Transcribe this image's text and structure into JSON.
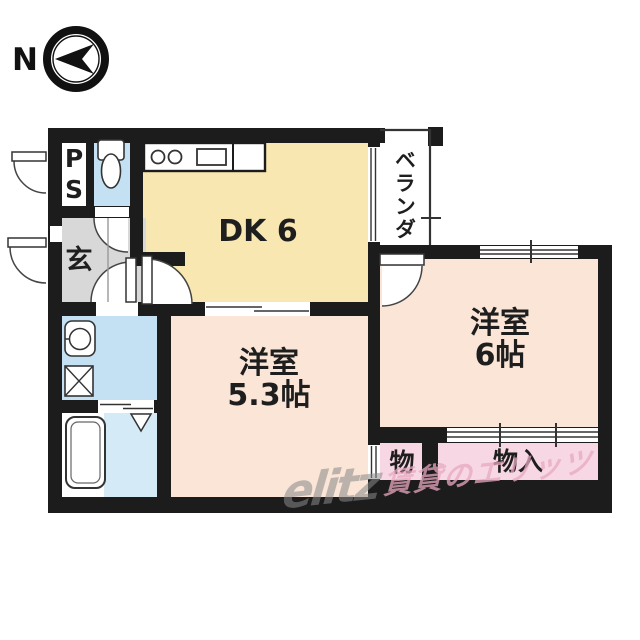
{
  "title": "1DK apartment floor plan",
  "compass": {
    "label": "N"
  },
  "rooms": {
    "ps": "PS",
    "dk": "DK 6",
    "veranda": "ベランダ",
    "entrance": "玄",
    "western1_name": "洋室",
    "western1_size": "5.3帖",
    "western2_name": "洋室",
    "western2_size": "6帖",
    "storage_small": "物",
    "storage_closet": "物入"
  },
  "watermark": {
    "logo": "elitz",
    "text": "賃貸のエリッツ"
  },
  "colors": {
    "wall": "#1c1c1c",
    "dk_floor": "#f8e7b0",
    "western_floor": "#fae5d7",
    "closet_floor": "#f6d7e3",
    "wet_floor": "#c3e1f2",
    "bath_floor": "#d4eaf6",
    "entrance_floor": "#d8d8d8",
    "watermark_logo": "#8a8a8a",
    "watermark_text": "#e8a9c0"
  }
}
